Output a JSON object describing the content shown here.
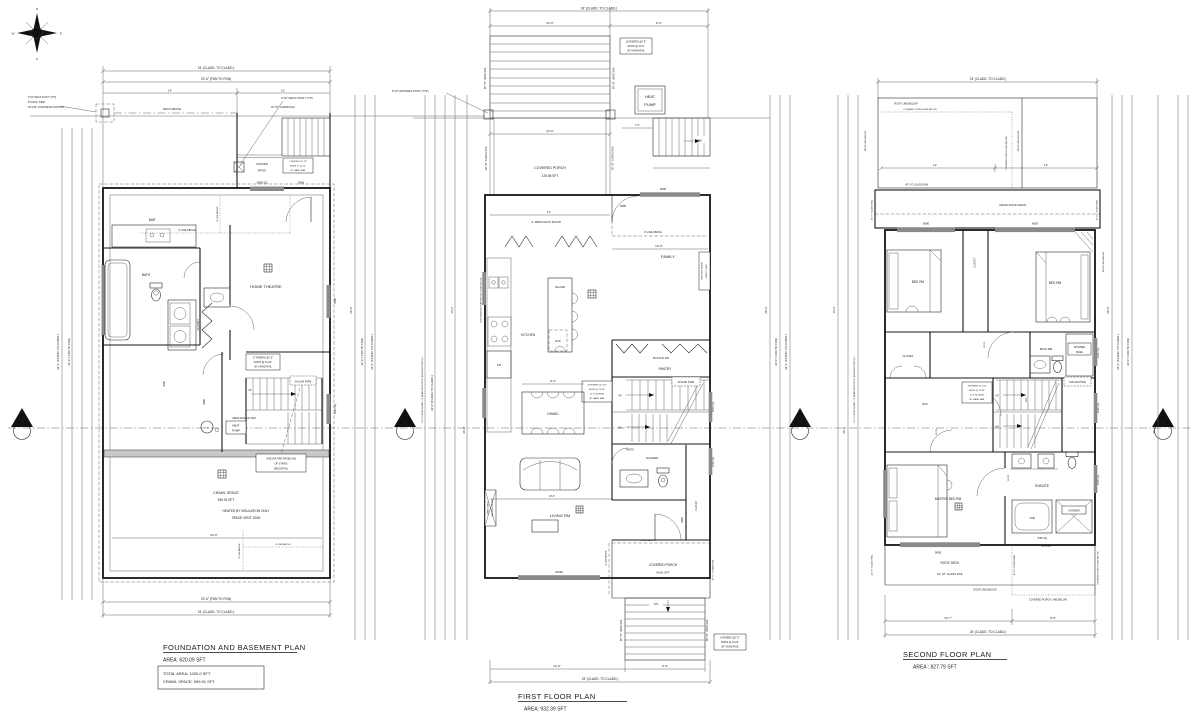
{
  "sheet": {
    "compass": {
      "n": "N",
      "e": "E",
      "s": "S",
      "w": "W"
    },
    "section_marker": "A"
  },
  "common": {
    "up": "UP",
    "dn": "DN",
    "solar_pipe": "SOLAR PIPE",
    "guard_rail_42": "42\" HT. GUARD RAIL",
    "hand_rail_36": "36\" HT. HAND RAIL",
    "glass_rail_42": "42\" HT. GLASS RAIL",
    "line8_above": "8' LINE ABOVE",
    "line9_above": "9' LINE ABOVE",
    "deck_above": "DECK ABOVE",
    "roof_line_below": "ROOF LINE BELOW",
    "porch_line_below": "COVERED PORCH LINE BELOW",
    "covered_porch": "COVERED PORCH",
    "closet": "CLOSET",
    "bed_rm": "BED RM",
    "dim_24_cladd": "24' (CLADD. TO CLADD.)",
    "dim_23_6_fdn": "23'-6\" (FDN TO FDN)",
    "dim_23_6": "23'-6\"",
    "dim_14": "14'",
    "dim_10": "10'",
    "dim_12": "12'",
    "dim_14_6": "14'-6\"",
    "dim_9_6": "9'-6\"",
    "dim_7_6": "7'-6\"",
    "dim_10_6": "10'-6\"",
    "dim_11_6": "11'-6\"",
    "dim_13_6": "13'-6\"",
    "dim_14_7": "14'-7\"",
    "vdim_42_6_fdn": "42'-6\" ( FDN TO FDN)",
    "vdim_42_6_cladd": "42'-6\" (CLADD. TO CLADD.)",
    "vdim_51_6": "51'-6\" FROM CLADD. TO REAR DECK POST (BUILDING DEPTH)",
    "vdim_28_6": "28'-6\"",
    "vdim_14_2": "14'-2\"",
    "vdim_36_6": "36'-6\"",
    "note_17": [
      "17 RISERS @7.5\"",
      "RUNS @ 10.24\"",
      "36\" HAND RAIL"
    ],
    "note_16": [
      "16 RISERS @7.44\"",
      "RUNS @ 10.24\"",
      "11.5\" NOSING",
      "36\" HAND RAIL"
    ],
    "note_10": [
      "10 RISERS @7.5\"",
      "RUNS @ 10.0\"",
      "36\" HAND RAIL"
    ],
    "note_8": [
      "8 RISERS @7.5\"",
      "RUNS @ 10.24\"",
      "36\" HAND RAIL"
    ],
    "note_7": [
      "7 RISERS @7.75\"",
      "RUNS @ 10.24\"",
      "36\" HAND RAIL"
    ]
  },
  "basement": {
    "title": "FOUNDATION AND BASEMENT PLAN",
    "area": "AREA:  620.09  SFT",
    "total_area": "TOTAL AREA:  1020.0  SFT",
    "crawl_area": "CRAWL SPACE:  399.91  SFT",
    "bar": "BAR",
    "bath": "BATH",
    "laundry": "LAUNDRY",
    "home_theatre": "HOME THEATRE",
    "mech_rm": "MECHANICAL RM",
    "crawl_space": "CRAWL SPACE",
    "crawl_sft": "399.91 SFT",
    "heated": "HEATED BY INSULATION ONLY",
    "vent": "SPACE VENT 1/500",
    "sunken": "SUNKEN",
    "patio": "PATIO",
    "hw": "H.W.",
    "heat": "HEAT",
    "pump": "PUMP",
    "fire_note": [
      "ONE HR FIRE RATED A/B",
      "OF STAIRS",
      "SEE DETAIL"
    ],
    "post_note": [
      "6\"x6\" DECK POST (TYP)",
      "8\"CONC. PIER",
      "36\"X36\" CONCRETE FOOTING"
    ],
    "post_note2": "6\"x6\" DECK POST (TYP)",
    "d3068": "3068",
    "w3068sq": "3068 SQ",
    "d3036": "3036",
    "d2668": "2668",
    "w5068": "5068",
    "w4030": "4030 SQ"
  },
  "first": {
    "title": "FIRST FLOOR PLAN",
    "area": "AREA:  932.39  SFT",
    "porch_sft": "125.98 SFT",
    "porch2_sft": "54.81 SFT",
    "family": "FAMILY",
    "kitchen": "KITCHEN",
    "island": "ISLAND",
    "dw": "D/W",
    "fr": "FR",
    "dining": "DINING",
    "living": "LIVING RM",
    "shower": "SHOWER",
    "pantry": "PANTRY",
    "bifold": "BI-FOLD DR",
    "nano": "3- 3080 NANO DOOR",
    "heat_pump": [
      "HEAT",
      "PUMP"
    ],
    "wood_post": "6\"x6\" WOODEN POST (TYP)",
    "win5020": "5020 WINDOW STARTING AT COUNTER LVL",
    "gasfp": [
      "GAS FIRE PLACE",
      "DIRECT VENT"
    ],
    "dblfp": [
      "DBBL SIDED",
      "GAS FIRE PLACE"
    ],
    "d3080": "3080",
    "w6080": "6080",
    "w10090": "10090",
    "d24070": "24070",
    "d2868": "2868",
    "w4030": "4030 SQ",
    "w2030": "2030 SQ"
  },
  "second": {
    "title": "SECOND FLOOR PLAN",
    "area": "AREA : 827.79 SFT",
    "rear_deck": "REAR ROOF DECK",
    "roof_deck": "ROOF DECK",
    "master": "MASTER BED RM",
    "wic": "WIC",
    "ensuite": "ENSUITE",
    "bath_rm": "BATH RM",
    "tub": "TUB",
    "shower": "SHOWER",
    "shower_base": [
      "SHOWER",
      "BASE"
    ],
    "w6080": "6080",
    "w6050": "6050",
    "w9090": "9090",
    "w7096": "7096 SQ",
    "sft1413": "14.13 sft",
    "d21070": "21070",
    "d2868": "2868",
    "w2030": "2030 SQ",
    "w4080": "4080 SQ",
    "w2050": "2050 SQ"
  }
}
